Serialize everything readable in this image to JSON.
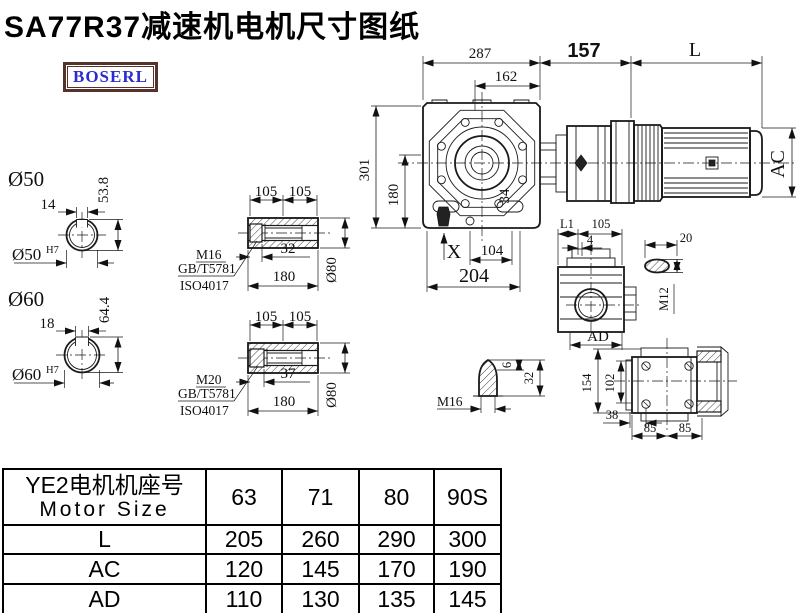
{
  "title": "SA77R37减速机电机尺寸图纸",
  "logo": "BOSERL",
  "main_view": {
    "d287": "287",
    "d162": "162",
    "d157": "157",
    "dL": "L",
    "d301": "301",
    "d180": "180",
    "d34": "34",
    "dAC": "AC",
    "dX": "X",
    "d104": "104",
    "d204": "204"
  },
  "shaft_detail_50": {
    "label": "Ø50",
    "key_width": "14",
    "height": "53.8",
    "bore": "Ø50",
    "tolerance": "H7"
  },
  "shaft_detail_60": {
    "label": "Ø60",
    "key_width": "18",
    "height": "64.4",
    "bore": "Ø60",
    "tolerance": "H7"
  },
  "hollow_shaft_1": {
    "dim_105a": "105",
    "dim_105b": "105",
    "thread": "M16",
    "standard_1": "GB/T5781",
    "standard_2": "ISO4017",
    "depth": "32",
    "length": "180",
    "diameter": "Ø80"
  },
  "hollow_shaft_2": {
    "dim_105a": "105",
    "dim_105b": "105",
    "thread": "M20",
    "standard_1": "GB/T5781",
    "standard_2": "ISO4017",
    "depth": "37",
    "length": "180",
    "diameter": "Ø80"
  },
  "side_view": {
    "dim_L1": "L1",
    "dim_105": "105",
    "dim_4": "4",
    "dim_AD": "AD"
  },
  "plug_detail": {
    "dim_20": "20",
    "thread": "M12"
  },
  "cone_detail": {
    "thread": "M16",
    "dim_6": "6",
    "dim_32": "32"
  },
  "rear_view": {
    "dim_154": "154",
    "dim_102": "102",
    "dim_38": "38",
    "dim_85a": "85",
    "dim_85b": "85"
  },
  "table": {
    "header_cn": "YE2电机机座号",
    "header_en": "Motor Size",
    "columns": [
      "63",
      "71",
      "80",
      "90S"
    ],
    "rows": [
      {
        "label": "L",
        "values": [
          "205",
          "260",
          "290",
          "300"
        ]
      },
      {
        "label": "AC",
        "values": [
          "120",
          "145",
          "170",
          "190"
        ]
      },
      {
        "label": "AD",
        "values": [
          "110",
          "130",
          "135",
          "145"
        ]
      }
    ]
  }
}
